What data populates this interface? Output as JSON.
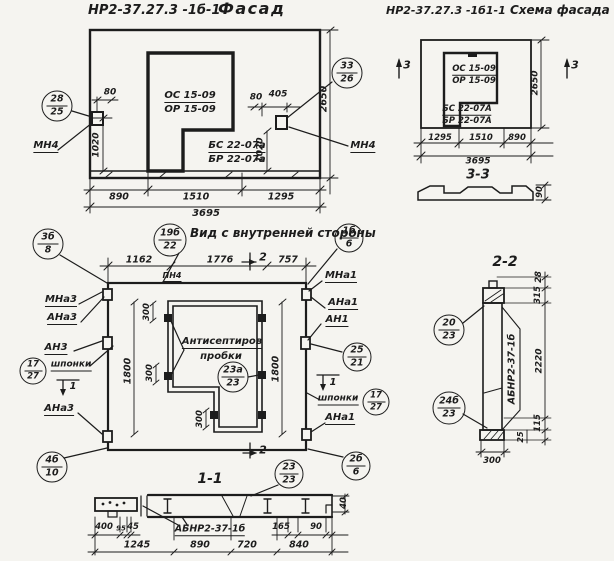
{
  "colors": {
    "paper": "#f5f4f0",
    "ink": "#1c1c1c"
  },
  "facade": {
    "title_code": "НР2-37.27.3 -1б-1",
    "title": "Фасад",
    "window_mark_top": "ОС 15-09",
    "window_mark_bottom": "ОР 15-09",
    "panel_mark_top": "БС 22-07а",
    "panel_mark_bottom": "БР 22-07а",
    "anchor_left": "МН4",
    "anchor_right": "МН4",
    "callout_left": {
      "num": "28",
      "sheet": "25"
    },
    "callout_right": {
      "num": "33",
      "sheet": "26"
    },
    "dim_80_left": "80",
    "dim_80_right": "80",
    "dim_405": "405",
    "dim_1020_left": "1020",
    "dim_1020_right": "1020",
    "dim_2650": "2650",
    "bottom_dims": [
      "890",
      "1510",
      "1295"
    ],
    "dim_total": "3695"
  },
  "scheme": {
    "title_code": "НР2-37.27.3 -1б1-1",
    "title": "Схема фасада",
    "window_mark_top": "ОС 15-09",
    "window_mark_bottom": "ОР 15-09",
    "panel_mark_top": "БС 22-07А",
    "panel_mark_bottom": "БР 22-07А",
    "section_mark": "3",
    "dim_2650": "2650",
    "bottom_dims": [
      "1295",
      "1510",
      "890"
    ],
    "dim_total": "3695",
    "section_title": "3-3",
    "dim_90": "90"
  },
  "inner": {
    "title": "Вид с внутренней стороны",
    "title_callout": {
      "num": "19б",
      "sheet": "22"
    },
    "top_dims": [
      "1162",
      "1776",
      "757"
    ],
    "label_pn4": "ПН4",
    "section_mark_2": "2",
    "section_mark_1": "1",
    "note_line1": "Антисептиров",
    "note_line2": "пробки",
    "plugs_callout": {
      "num": "23а",
      "sheet": "23"
    },
    "dim_300": "300",
    "dim_1800": "1800",
    "left": {
      "callout_top": {
        "num": "3б",
        "sheet": "8"
      },
      "label_mna3": "МНа3",
      "label_ana3": "АНа3",
      "label_an3": "АН3",
      "label_shponki": "шпонки",
      "callout_shponki": {
        "num": "17",
        "sheet": "27"
      },
      "label_ana3_b": "АНа3",
      "callout_bottom": {
        "num": "4б",
        "sheet": "10"
      }
    },
    "right": {
      "callout_top": {
        "num": "1б",
        "sheet": "6"
      },
      "label_mna1": "МНа1",
      "label_ana1": "АНа1",
      "label_an1": "АН1",
      "callout_mid": {
        "num": "25",
        "sheet": "21"
      },
      "label_shponki": "шпонки",
      "callout_shponki": {
        "num": "17",
        "sheet": "27"
      },
      "label_ana1_b": "АНа1",
      "callout_bottom": {
        "num": "2б",
        "sheet": "6"
      }
    }
  },
  "section22": {
    "title": "2-2",
    "panel_label": "АБНР2-37-1б",
    "callout_top": {
      "num": "20",
      "sheet": "23"
    },
    "callout_bottom": {
      "num": "24б",
      "sheet": "23"
    },
    "dim_28": "28",
    "dim_315": "315",
    "dim_2220": "2220",
    "dim_115": "115",
    "dim_25": "25",
    "dim_300": "300"
  },
  "section11": {
    "title": "1-1",
    "callout": {
      "num": "23",
      "sheet": "23"
    },
    "panel_label": "АБНР2-37-1б",
    "dims_small": [
      "400",
      "95",
      "45"
    ],
    "dim_165": "165",
    "dim_90": "90",
    "dim_40": "40",
    "bottom_dims": [
      "1245",
      "890",
      "720",
      "840"
    ]
  }
}
